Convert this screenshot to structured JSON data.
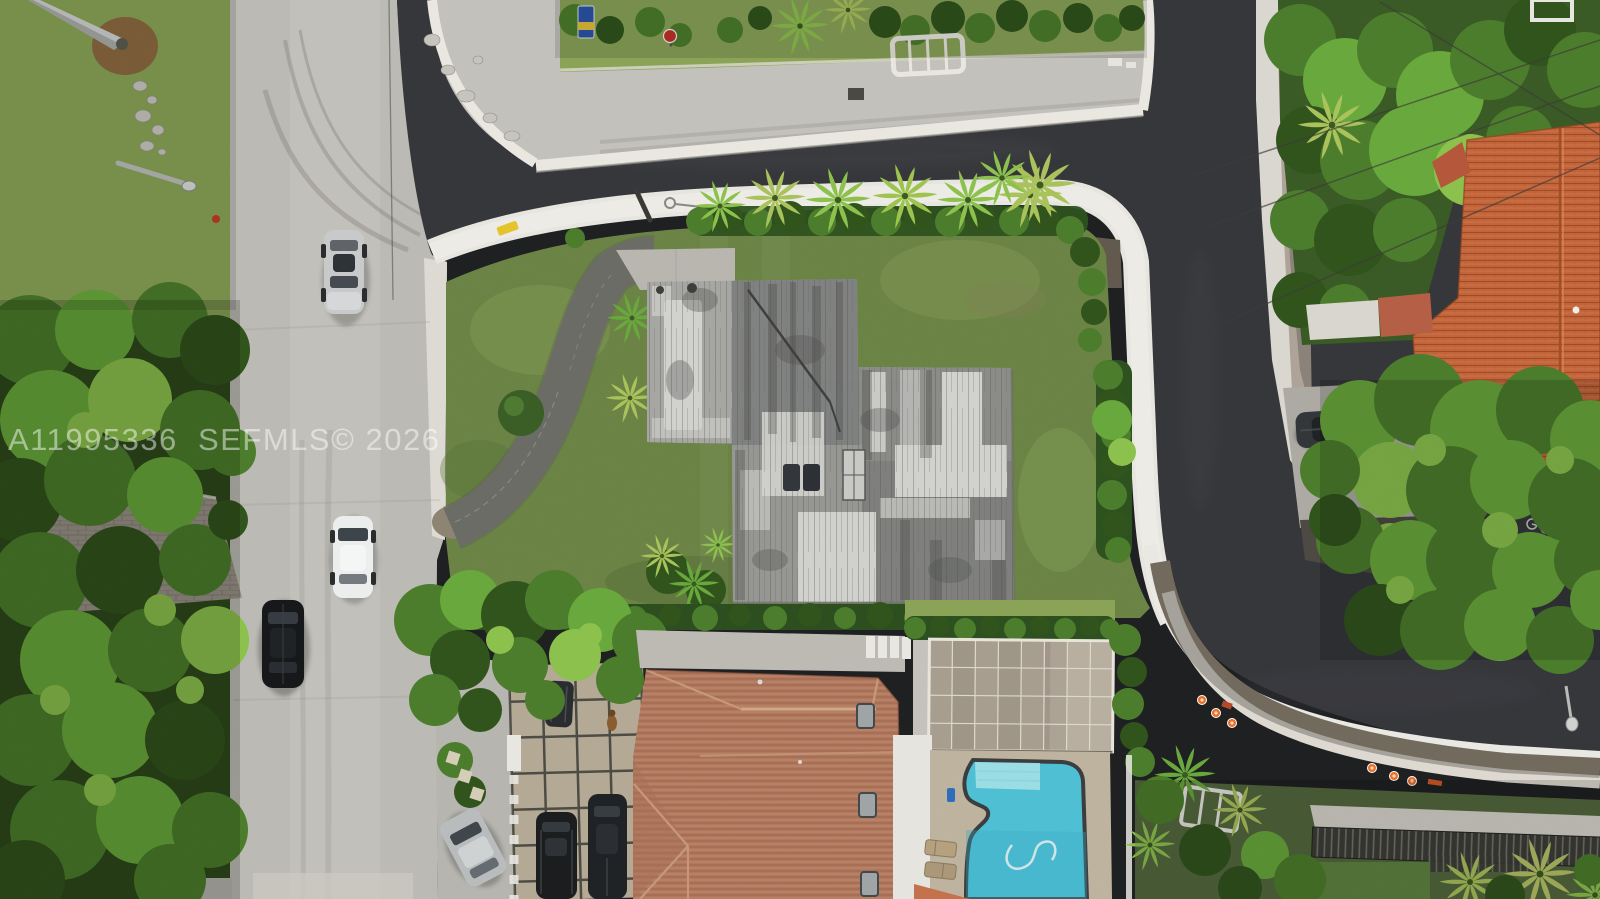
{
  "image": {
    "kind": "aerial-drone-photograph",
    "width": 1600,
    "height": 899,
    "description": "Top-down aerial photo of a waterfront residential corner lot on a dark canal: vacant flat-roof house on a large lawn, curving concrete seawall walkway, neighborhood street with cars at left, terracotta-roof neighbor with screened pool enclosure and turquoise pool at bottom, bright orange tile roof house at top right"
  },
  "watermark": {
    "text": "A11995336  SEFMLS© 2026"
  },
  "palette": {
    "water": "#36373b",
    "road": "#bcbab4",
    "seawall": "#e7e5df",
    "lawn": "#7e9b52",
    "lawnlight": "#93ad5f",
    "flatroof": "#a3a3a0",
    "tilesalmon": "#c08468",
    "tileorange": "#c2653c",
    "pool": "#4fc0d4",
    "pooldeck": "#cfc3ae",
    "pavers": "#cdc2ab",
    "enclosure": "#a89e90",
    "asphalt": "#6b6c66",
    "cone": "#e8702a"
  },
  "objects": [
    {
      "name": "canal-water",
      "label": "dark canal water"
    },
    {
      "name": "street-vertical",
      "label": "residential street with traffic"
    },
    {
      "name": "street-top",
      "label": "street along far canal bank"
    },
    {
      "name": "seawall-walkway",
      "label": "white concrete seawall cap walkway"
    },
    {
      "name": "flat-roof-house",
      "label": "vacant flat-roof house on subject lot"
    },
    {
      "name": "tile-roof-house",
      "label": "terracotta tile roof neighbor house"
    },
    {
      "name": "orange-roof-house",
      "label": "orange barrel-tile roof house"
    },
    {
      "name": "screened-pool-enclosure",
      "label": "screened lanai enclosure"
    },
    {
      "name": "swimming-pool",
      "label": "freeform turquoise pool"
    },
    {
      "name": "cars",
      "label": "sedans and SUVs on street and driveways"
    },
    {
      "name": "traffic-cones",
      "label": "orange cones on seawall repair strips"
    },
    {
      "name": "stop-sign",
      "label": "stop sign on far bank"
    }
  ]
}
